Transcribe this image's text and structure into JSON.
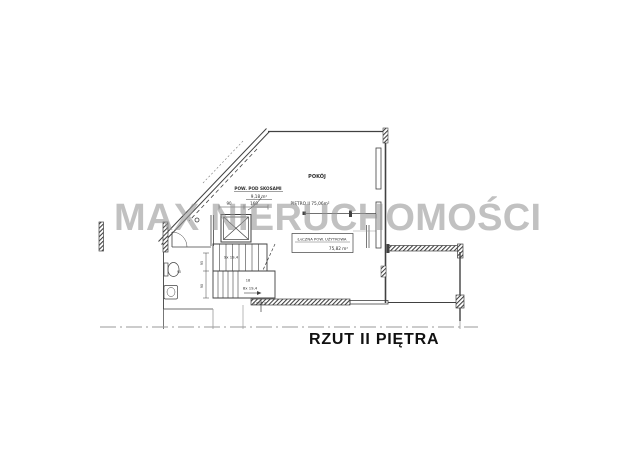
{
  "watermark": "MAX NIERUCHOMOŚCI",
  "caption": "RZUT II PIĘTRA",
  "room": {
    "name": "POKÓJ",
    "area_note": "PIĘTRO II 75,06m²"
  },
  "annotations": {
    "slope": {
      "label": "POW. POD SKOSAMI",
      "area": "9,18 m²"
    },
    "usable": {
      "label": "ŁĄCZNA POW. UŻYTKOWA",
      "area": "75,82 m²"
    },
    "door_dim": "1,20/2,0"
  },
  "stairs": {
    "flight_up": "9x 19,4",
    "step_count": "18",
    "flight_down": "8x 19,4"
  },
  "dims": {
    "shaft_width": "90",
    "shaft_depth": "160",
    "bath": "90",
    "left_a": "95",
    "left_b": "90"
  },
  "colors": {
    "line": "#414141",
    "gray_line": "#9a9a9a",
    "watermark": "#949494",
    "background": "#ffffff",
    "caption": "#111111"
  }
}
